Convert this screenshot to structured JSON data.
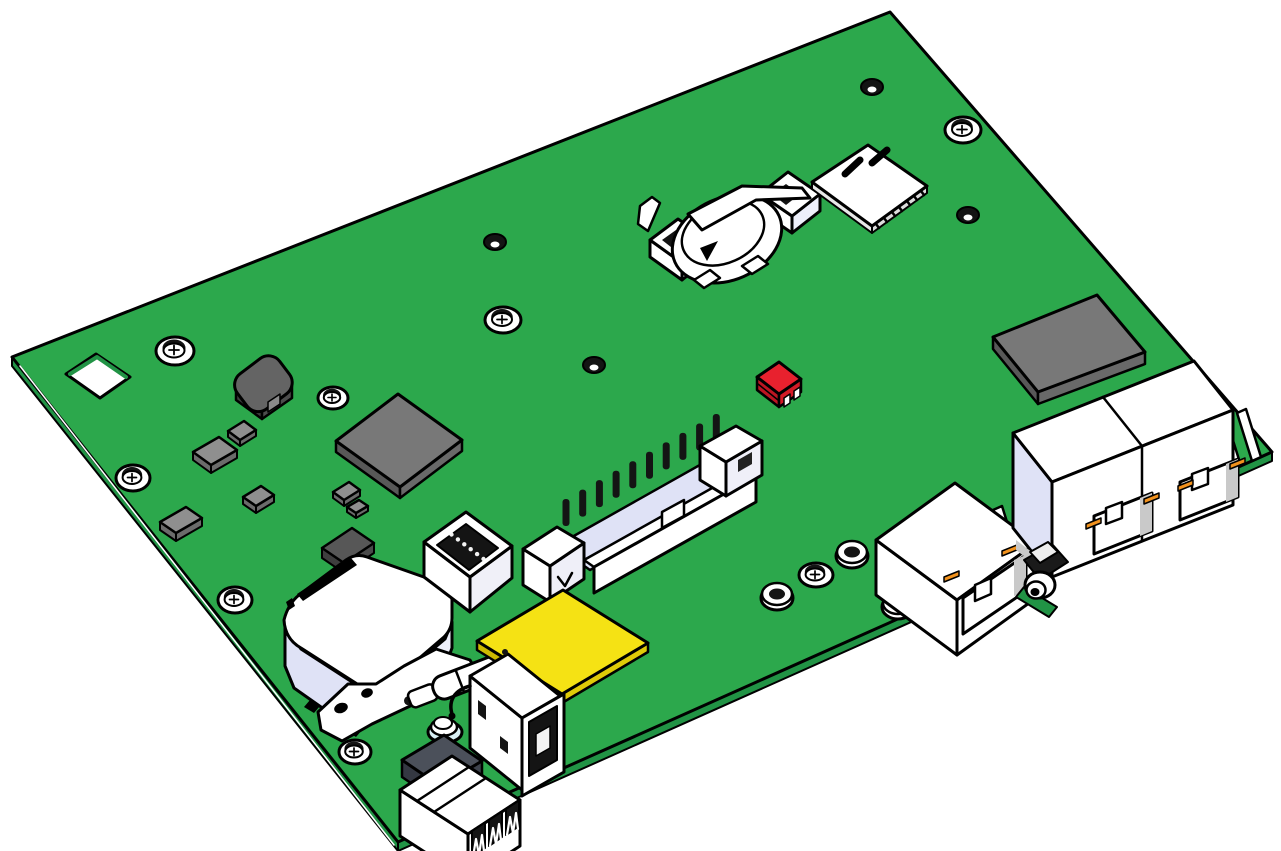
{
  "scene": {
    "type": "cad-render",
    "description": "Isometric CAD rendering of a green printed circuit board assembly with connectors and components",
    "components": [
      {
        "id": "pcb-board",
        "label": "Green PCB board"
      },
      {
        "id": "coin-cell-holder",
        "label": "Coin cell battery holder"
      },
      {
        "id": "sim-card-slot",
        "label": "SIM card slot"
      },
      {
        "id": "rf-module",
        "label": "Gray RF shield module"
      },
      {
        "id": "red-jumper",
        "label": "Small red jumper block"
      },
      {
        "id": "dual-rj45",
        "label": "Dual RJ45 ethernet jack"
      },
      {
        "id": "single-rj45",
        "label": "Single RJ45 ethernet jack"
      },
      {
        "id": "antenna-connector",
        "label": "Coaxial antenna connector"
      },
      {
        "id": "idc-header",
        "label": "Shrouded IDC pin header"
      },
      {
        "id": "box-header",
        "label": "Six pin box header"
      },
      {
        "id": "ic-chip",
        "label": "Gray IC chip"
      },
      {
        "id": "power-inductor",
        "label": "Dark power inductor"
      },
      {
        "id": "relay",
        "label": "White relay with printed marking"
      },
      {
        "id": "metal-bracket",
        "label": "Metal mounting bracket"
      },
      {
        "id": "glass-fuse",
        "label": "Cylindrical fuse"
      },
      {
        "id": "yellow-module",
        "label": "Yellow module"
      },
      {
        "id": "usb-a-port",
        "label": "USB-A port"
      },
      {
        "id": "terminal-block",
        "label": "Three position terminal block"
      },
      {
        "id": "push-button",
        "label": "Dome button"
      },
      {
        "id": "mounting-holes",
        "label": "Screw mounting holes",
        "count": 8
      },
      {
        "id": "standoff-holes",
        "label": "Plated standoff holes",
        "count": 3
      },
      {
        "id": "vias",
        "label": "Through-hole vias",
        "count": 4
      },
      {
        "id": "smd-passives",
        "label": "SMD passive components",
        "count": 6
      },
      {
        "id": "board-cutout",
        "label": "Square board cutout"
      }
    ],
    "colors": {
      "board_top": "#2CA84C",
      "board_side": "#219345",
      "outline": "#000000",
      "white": "#FFFFFF",
      "lavender": "#DFE2F6",
      "lavender_light": "#EDEFFA",
      "gray_chip": "#787878",
      "gray_chip_side": "#585858",
      "gray_chip_side2": "#696969",
      "gray_dark": "#646464",
      "gray_dark_side": "#3E3E3E",
      "smd_gray": "#8F8F8F",
      "smd_gray_side": "#6B6B6B",
      "slate_dark": "#4B505A",
      "slate_dark_side": "#343842",
      "red_top": "#E8212E",
      "red_side": "#BD1522",
      "red_front": "#D31A26",
      "yellow_top": "#F5E214",
      "yellow_side": "#CCB900",
      "yellow_front": "#DFCA08",
      "orange": "#F2921D",
      "inner_black": "#141414",
      "shadow_gray": "#C9C9C9",
      "dome_tint": "#D8EFF4"
    }
  }
}
